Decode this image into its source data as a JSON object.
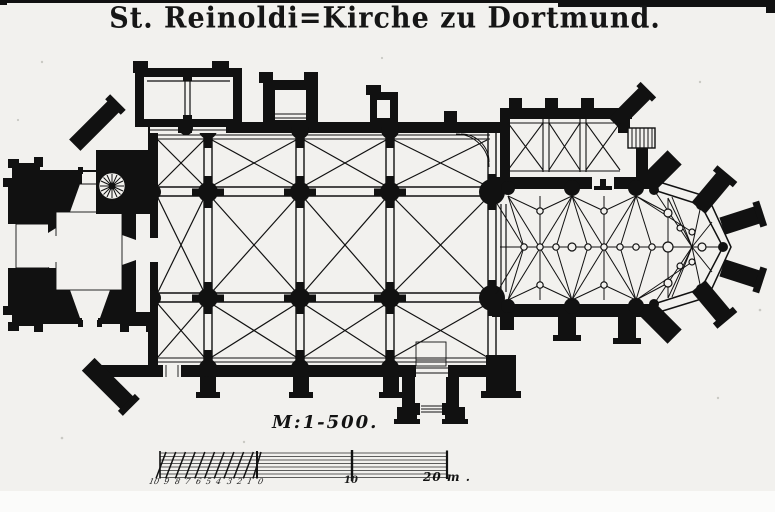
{
  "title": {
    "text": "St. Reinoldi=Kirche zu Dortmund."
  },
  "scale": {
    "ratio_label": "M:1-500.",
    "bar_numbers": [
      "10",
      "9",
      "8",
      "7",
      "6",
      "5",
      "4",
      "3",
      "2",
      "1",
      "0"
    ],
    "mid_tick_label": "10",
    "end_label": "20 m ."
  },
  "plan": {
    "paper_color": "#f2f1ee",
    "ink_color": "#111111",
    "elements": [
      "west-tower",
      "west-porch",
      "spiral-staircase",
      "north-chapel",
      "nave-vault-grid",
      "south-porch",
      "choir-star-vault",
      "apse",
      "sacristy",
      "sacristy-stairs"
    ]
  }
}
